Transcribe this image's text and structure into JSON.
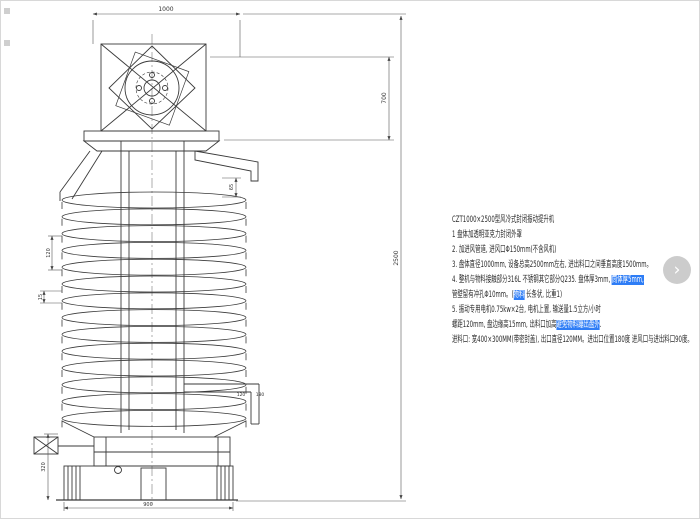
{
  "colors": {
    "ink": "#3a3a3a",
    "dim_line": "#555555",
    "highlight_bg": "#2e7df6",
    "highlight_text": "#ffffff",
    "frame": "#d8d8d8",
    "next_button_bg": "#c4c4c4"
  },
  "drawing": {
    "dims": {
      "top_width": "1000",
      "upper_height": "700",
      "overall_height": "2500",
      "pitch": "120",
      "tray_edge": "15",
      "spout_drop": "65",
      "discharge_w1": "120",
      "discharge_w2": "180",
      "base_height": "320",
      "base_width": "900"
    }
  },
  "notes": {
    "title": "CZT1000×2500型风冷式封闭振动提升机",
    "lines": [
      {
        "segments": [
          {
            "text": "1 盘体加透明亚克力封闭外罩",
            "highlight": false
          }
        ]
      },
      {
        "segments": [
          {
            "text": "2. 加进风管道, 进风口Φ150mm(不含风机)",
            "highlight": false
          }
        ]
      },
      {
        "segments": [
          {
            "text": "3. 盘体直径1000mm, 设备总高2500mm左右, 进出料口之间垂直高度1500mm。",
            "highlight": false
          }
        ]
      },
      {
        "segments": [
          {
            "text": "4. 整机与物料接触部分316L 不锈钢其它部分Q235. 盘体厚3mm, ",
            "highlight": false
          },
          {
            "text": "筒体厚5mm,",
            "highlight": true
          }
        ]
      },
      {
        "segments": [
          {
            "text": "管壁留有冲孔Φ10mm。(",
            "highlight": false
          },
          {
            "text": "物料",
            "highlight": true
          },
          {
            "text": " 长条状, 比重1)",
            "highlight": false
          }
        ]
      },
      {
        "segments": [
          {
            "text": "5. 振动专用电机0.75kw×2台, 电机上置, 输送量1.5立方/小时",
            "highlight": false
          }
        ]
      },
      {
        "segments": [
          {
            "text": "螺距120mm, 盘边缘高15mm, 出料口加高",
            "highlight": false
          },
          {
            "text": "避免物料蹦出盘外",
            "highlight": true
          },
          {
            "text": ".",
            "highlight": false
          }
        ]
      },
      {
        "segments": [
          {
            "text": "进料口: 宽400×300MM(带密封盖), 出口直径120MM。进出口位置180度 进风口与进出料口90度。",
            "highlight": false
          }
        ]
      }
    ]
  },
  "overlay": {
    "next_arrow": "›"
  }
}
